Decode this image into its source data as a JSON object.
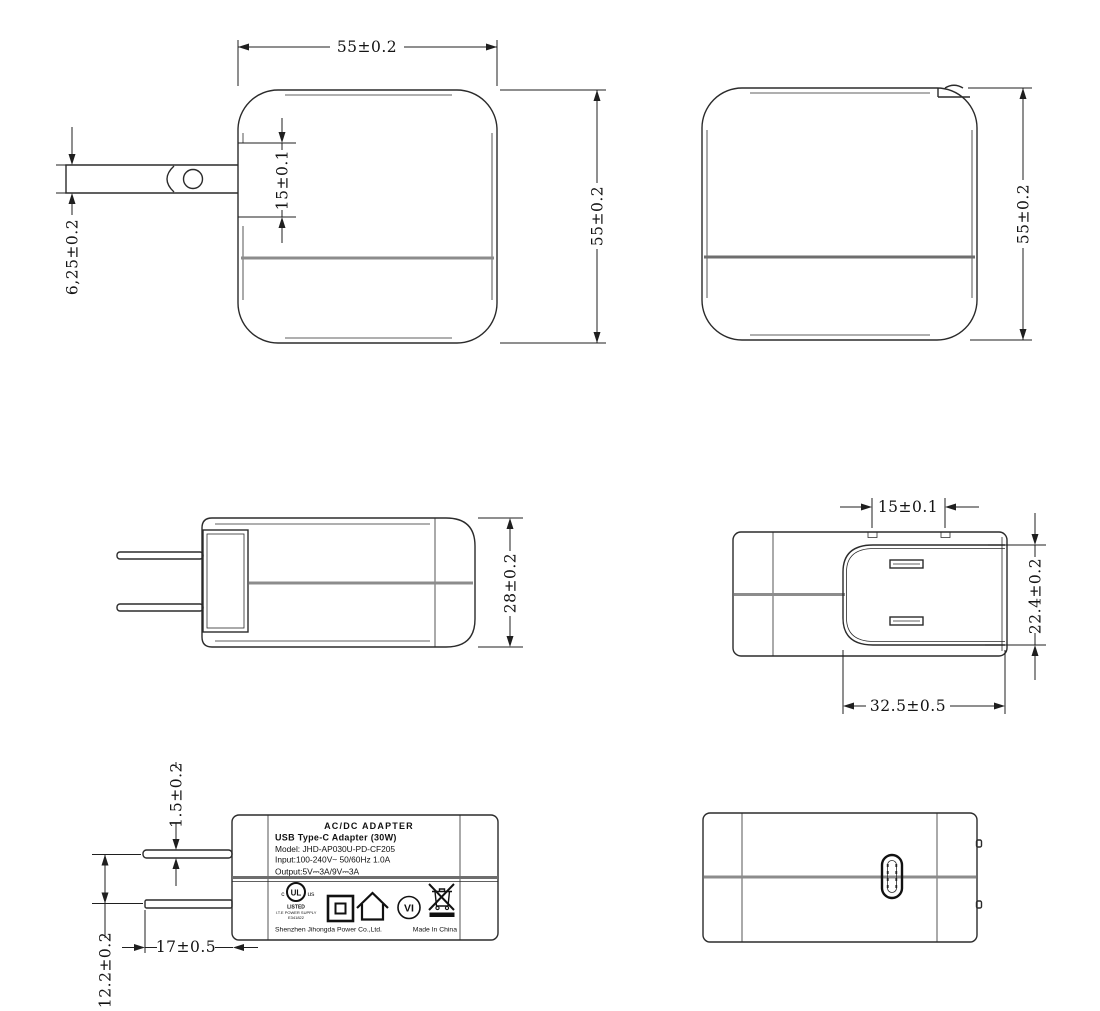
{
  "document": {
    "type": "engineering-dimension-drawing",
    "subject": "USB Type-C wall adapter, six orthographic views",
    "colors": {
      "background": "#ffffff",
      "line": "#2b2b2b",
      "seam_gray": "#8c8c8c",
      "label_seam": "#6e6e6e",
      "text": "#141414"
    }
  },
  "dims": {
    "front_width": "55±0.2",
    "front_height": "55±0.2",
    "front_plug_module": "15±0.1",
    "front_blade_width": "6,25±0.2",
    "back_height": "55±0.2",
    "side_thickness": "28±0.2",
    "top_blade_pitch": "15±0.1",
    "top_recess_depth": "22.4±0.2",
    "top_recess_width": "32.5±0.5",
    "blade_thickness": "1.5±0.2",
    "blade_spacing": "12.2±0.2",
    "blade_length": "17±0.5"
  },
  "label": {
    "line1": "AC/DC  ADAPTER",
    "line2": "USB Type-C Adapter   (30W)",
    "line3": "Model: JHD-AP030U-PD-CF205",
    "line4": "Input:100-240V~  50/60Hz  1.0A",
    "line5": "Output:5V⎓3A/9V⎓3A",
    "ul": {
      "c": "c",
      "monogram": "UL",
      "us": "us",
      "listed": "LISTED",
      "category": "I.T.E POWER SUPPLY",
      "file_number": "E341822"
    },
    "efficiency_mark": "VI",
    "manufacturer": "Shenzhen Jihongda Power Co.,Ltd.",
    "origin": "Made In China"
  },
  "icons": {
    "ul": "ul-listed-icon",
    "class_ii": "class-ii-insulation-icon",
    "indoor": "indoor-use-only-icon",
    "efficiency": "efficiency-level-vi-icon",
    "weee": "weee-crossed-bin-icon"
  }
}
